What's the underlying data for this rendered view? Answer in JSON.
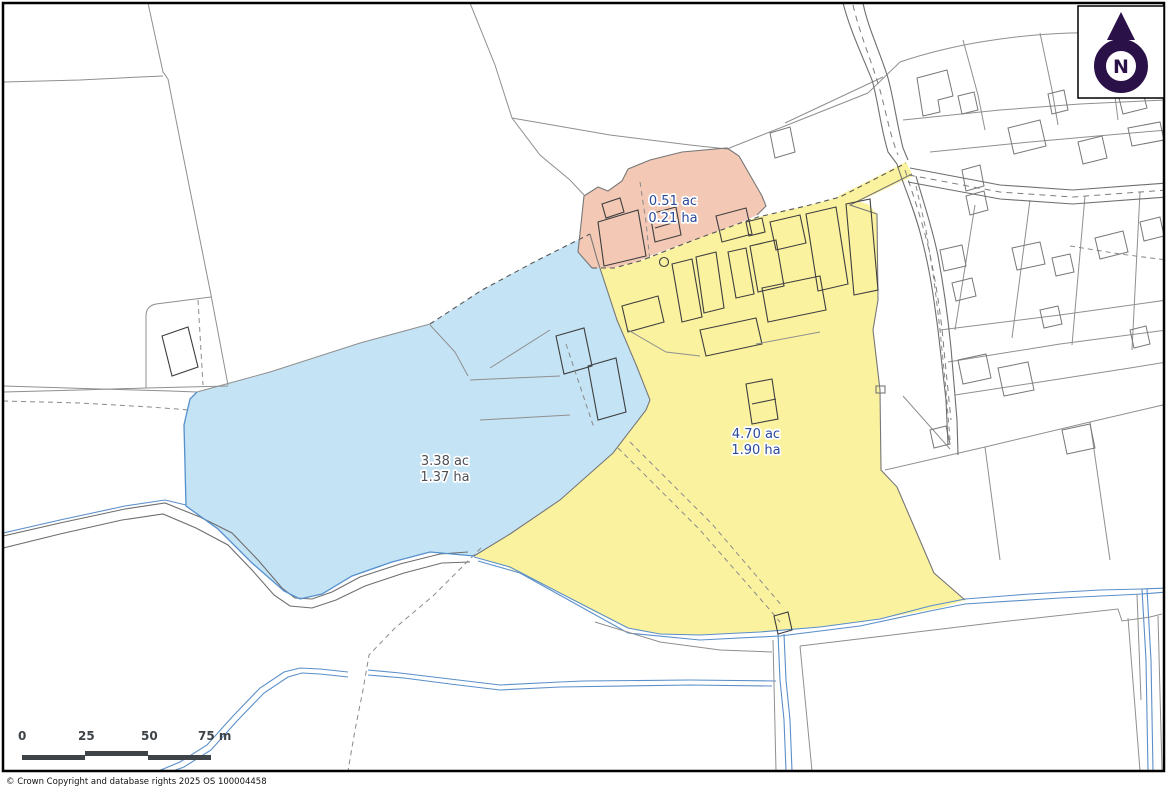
{
  "map": {
    "parcels": [
      {
        "id": "pink-parcel",
        "area_ac": "0.51 ac",
        "area_ha": "0.21 ha",
        "fill": "#f3c9b6",
        "label_color": "#2b4a9b"
      },
      {
        "id": "blue-parcel",
        "area_ac": "3.38 ac",
        "area_ha": "1.37 ha",
        "fill": "#c4e3f5",
        "label_color": "#4b4f58"
      },
      {
        "id": "yellow-parcel",
        "area_ac": "4.70 ac",
        "area_ha": "1.90 ha",
        "fill": "#fbf2a0",
        "label_color": "#2b4a9b"
      }
    ],
    "north_arrow": {
      "letter": "N",
      "color": "#2a1148"
    },
    "scale_bar": {
      "tick_labels": [
        "0",
        "25",
        "50",
        "75 m"
      ],
      "bar_color": "#3d4347"
    },
    "copyright": "© Crown Copyright and database rights 2025 OS 100004458"
  }
}
